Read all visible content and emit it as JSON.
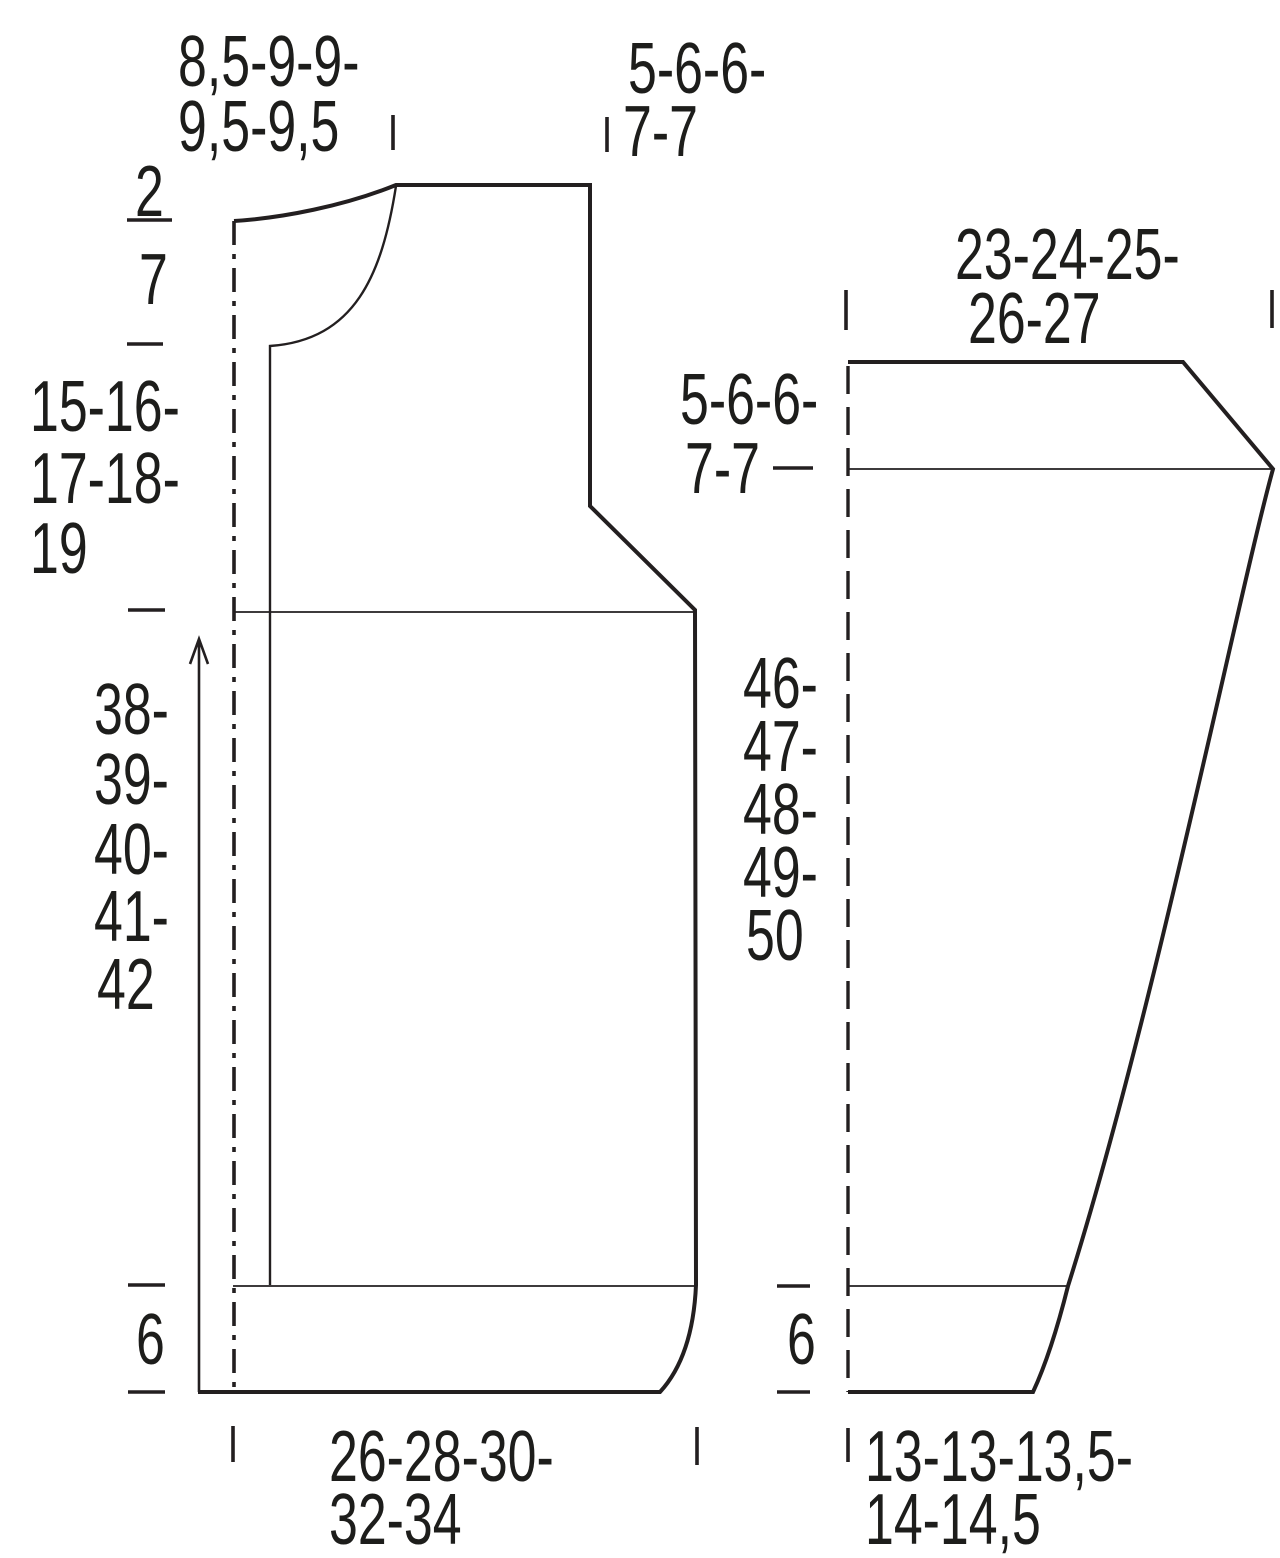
{
  "diagram_type": "knitting pattern garment schematic",
  "colors": {
    "line": "#231f20",
    "text": "#1d1d1b",
    "background": "#ffffff"
  },
  "body": {
    "neck_width": [
      "8,5-9-9-",
      "9,5-9,5"
    ],
    "shoulder_width": [
      "5-6-6-",
      "7-7"
    ],
    "neck_depth_upper": "2",
    "neck_depth_lower": "7",
    "armhole_depth": [
      "15-16-",
      "17-18-",
      "19"
    ],
    "side_length": [
      "38-",
      "39-",
      "40-",
      "41-",
      "42"
    ],
    "ribbing_height": "6",
    "bottom_width": [
      "26-28-30-",
      "32-34"
    ]
  },
  "sleeve": {
    "top_width": [
      "23-24-25-",
      "26-27"
    ],
    "cap_height": [
      "5-6-6-",
      "7-7"
    ],
    "length": [
      "46-",
      "47-",
      "48-",
      "49-",
      "50"
    ],
    "ribbing_height": "6",
    "cuff_width": [
      "13-13-13,5-",
      "14-14,5"
    ]
  }
}
